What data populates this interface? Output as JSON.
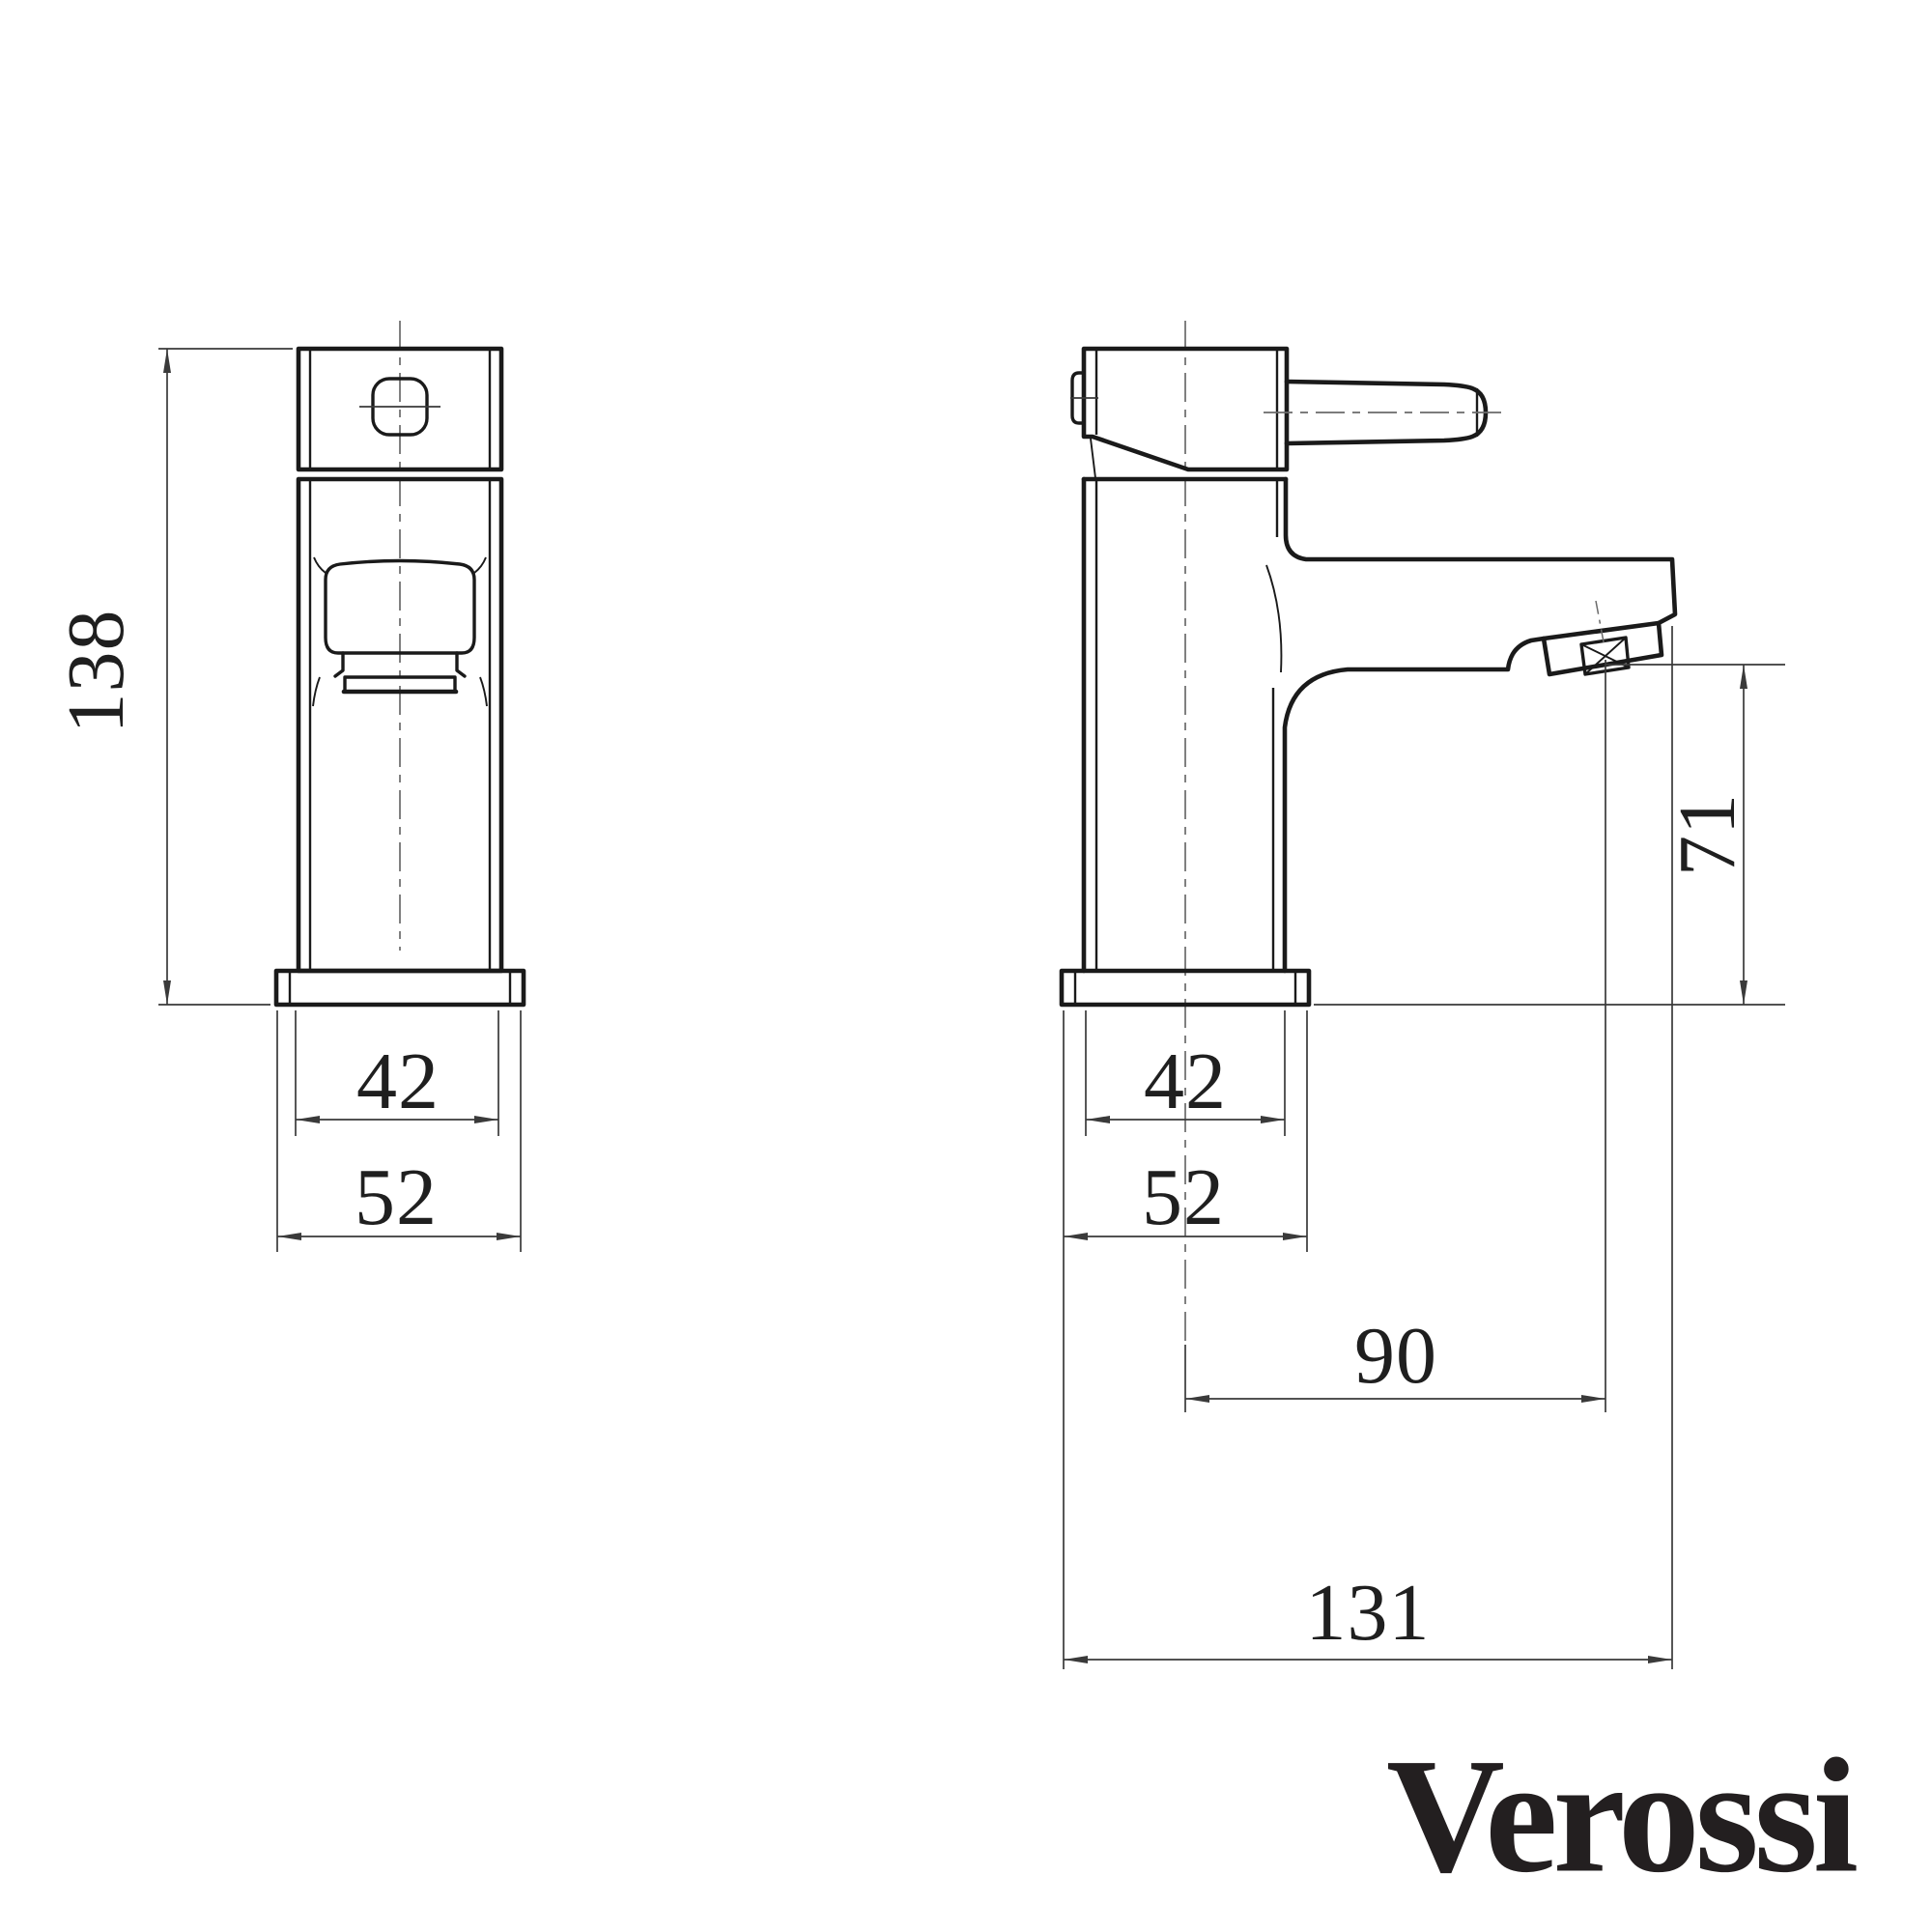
{
  "drawing": {
    "title": "tap-technical-drawing",
    "front_view": {
      "dims": {
        "height": "138",
        "body_width": "42",
        "base_width": "52"
      }
    },
    "side_view": {
      "dims": {
        "spout_height": "71",
        "body_width": "42",
        "base_width": "52",
        "spout_reach": "90",
        "overall_depth": "131"
      }
    },
    "brand": {
      "name": "Verossi"
    },
    "colors": {
      "background": "#ffffff",
      "outline": "#1a1a1a",
      "dimension": "#3a3a3a",
      "centerline": "#6a6a6a",
      "text": "#1f1f1f",
      "logo": "#231f20"
    }
  }
}
